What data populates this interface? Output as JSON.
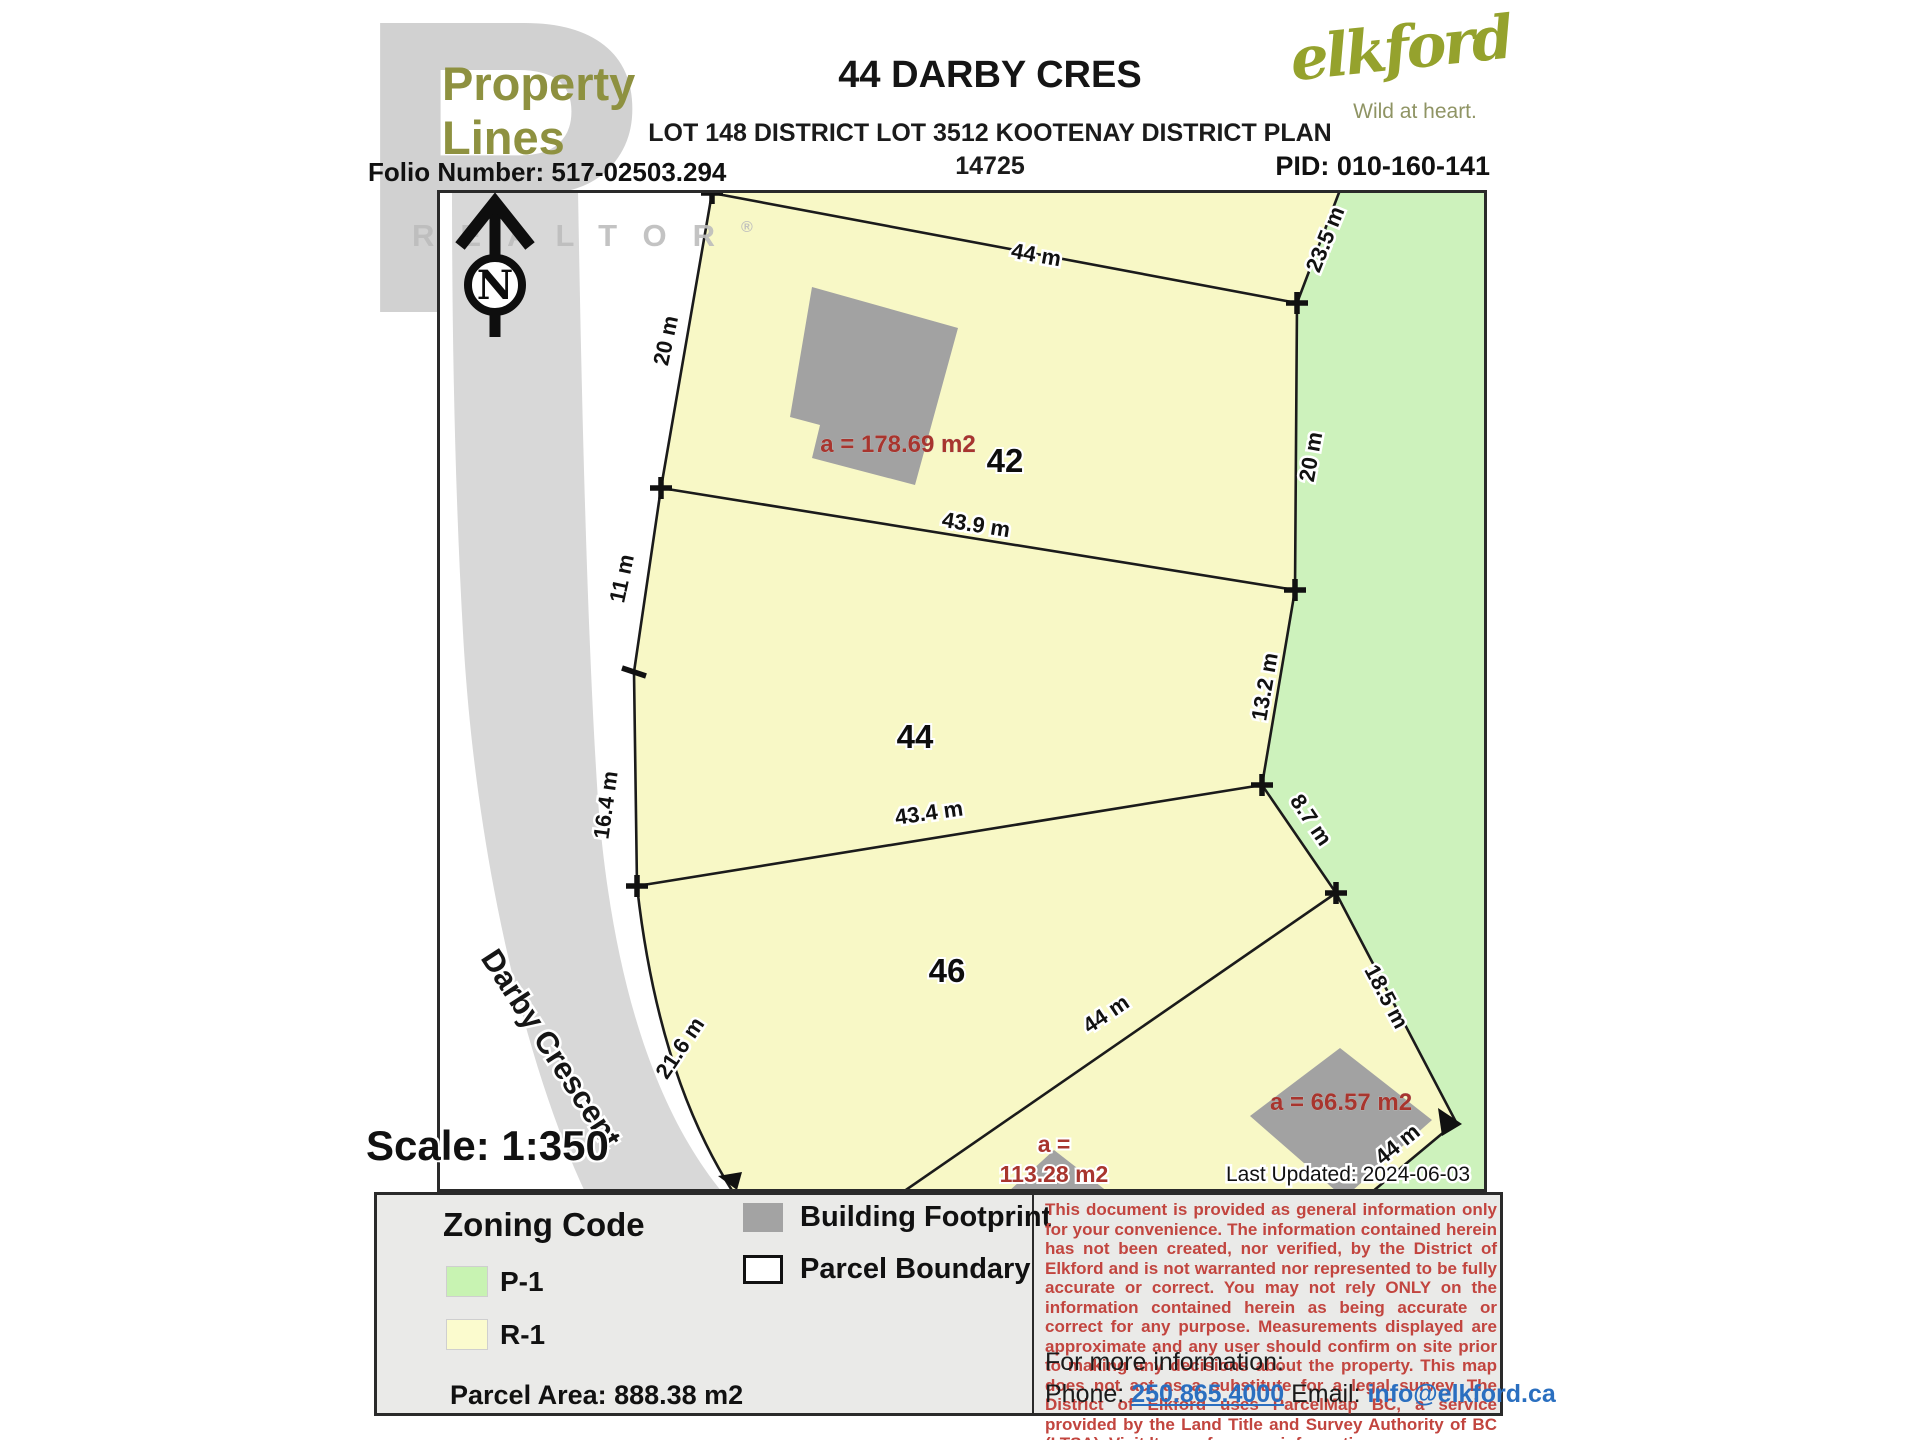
{
  "header": {
    "logo_line1": "Property",
    "logo_line2": "Lines",
    "watermark_letter": "R",
    "watermark_word": "REALTOR",
    "watermark_reg": "®",
    "title": "44 DARBY CRES",
    "subtitle": "LOT 148 DISTRICT LOT 3512 KOOTENAY DISTRICT PLAN",
    "plan_number": "14725",
    "folio": "Folio Number: 517-02503.294",
    "pid": "PID: 010-160-141",
    "brand": {
      "name": "elkford",
      "tagline": "Wild at heart."
    }
  },
  "map": {
    "north_letter": "N",
    "street": "Darby Crescent",
    "scale_label": "Scale: 1:350",
    "last_updated": "Last Updated: 2024-06-03",
    "parcels": {
      "lot42": "42",
      "lot44": "44",
      "lot46": "46"
    },
    "buildings": {
      "lot42_area": "a = 178.69 m2",
      "lot46_area": "a = 66.57 m2",
      "bottom_area_line1": "a =",
      "bottom_area_line2": "113.28 m2"
    },
    "dims": {
      "top": "44 m",
      "ne": "23.5 m",
      "east_upper": "20 m",
      "west_upper": "20 m",
      "lot42_south": "43.9 m",
      "west_mid": "11 m",
      "west_lower": "16.4 m",
      "east_mid": "13.2 m",
      "lot44_south": "43.4 m",
      "sw_curve": "21.6 m",
      "se_upper": "8.7 m",
      "se_lower": "18.5 m",
      "lot46_diag": "44 m",
      "se_bottom": "44 m"
    }
  },
  "legend": {
    "zoning_title": "Zoning Code",
    "zones": [
      {
        "code": "P-1",
        "color": "#c8f3b2"
      },
      {
        "code": "R-1",
        "color": "#fbfbce"
      }
    ],
    "building_footprint": "Building Footprint",
    "parcel_boundary": "Parcel Boundary",
    "parcel_area": "Parcel Area: 888.38 m2"
  },
  "disclaimer": {
    "text": "This document is provided as general information only for your convenience. The information contained herein has not been created, nor verified, by the District of Elkford and is not warranted nor represented to be fully accurate or correct. You may not rely ONLY on the information contained herein as being accurate or correct for any purpose. Measurements displayed are approximate and any user should confirm on site prior to making any decisions about the property. This map does not act as a substitute for a legal survey. The District of Elkford uses ParcelMap BC, a service provided by the Land Title and Survey Authority of BC (LTSA).  Visit ltsa.ca for more information.",
    "more_info": "For more information:",
    "phone_label": "Phone: ",
    "phone": "250.865.4000",
    "email_label": " Email: ",
    "email": "info@elkford.ca"
  },
  "colors": {
    "brand_olive": "#8e9140",
    "elkford_olive": "#95a22d",
    "zone_p1_green": "#cdf2bc",
    "zone_r1_yellow": "#f8f8c6",
    "building_gray": "#a2a2a2",
    "road_gray": "#d8d8d8",
    "red_area_label": "#a8352e",
    "disclaimer_red": "#c2453f",
    "link_blue": "#2a6fc0"
  }
}
